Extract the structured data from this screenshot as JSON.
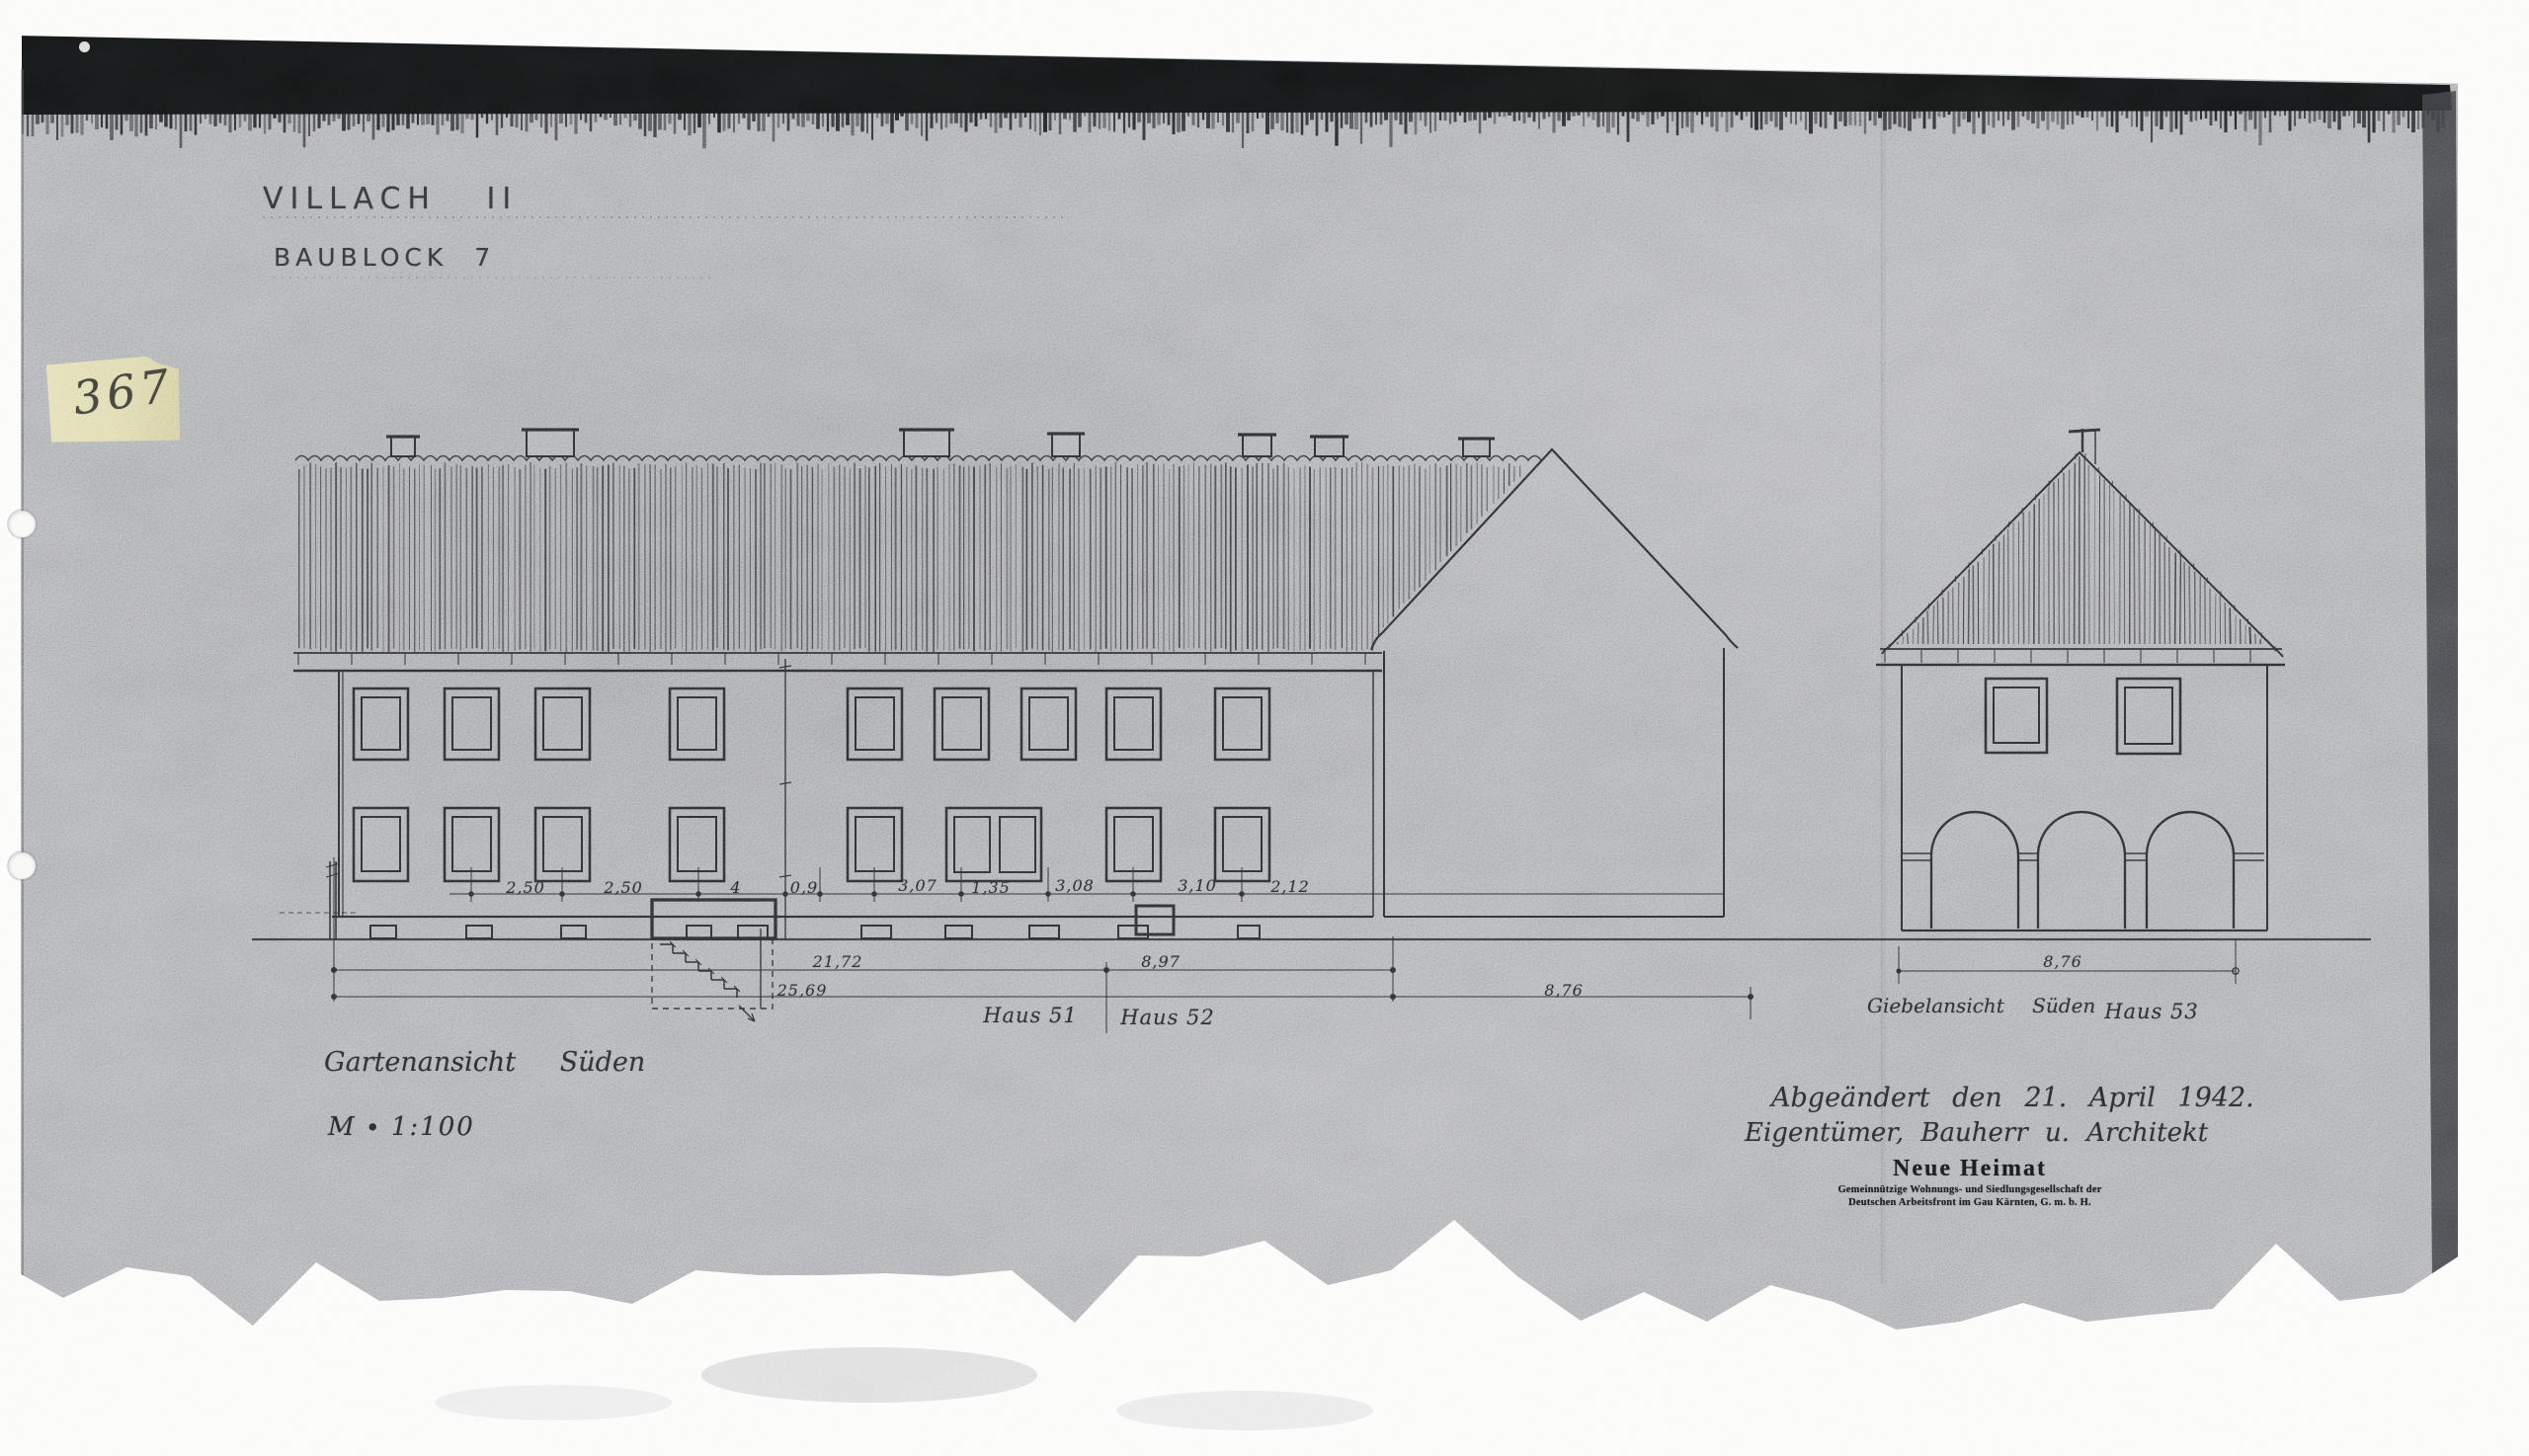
{
  "page": {
    "title": "VILLACH II",
    "subtitle": "BAUBLOCK 7"
  },
  "sticky_note": {
    "number": "367"
  },
  "annotations": {
    "view_left": "Gartenansicht Süden",
    "scale": "M ∙ 1:100",
    "view_right": "Giebelansicht Süden",
    "haus51": "Haus 51",
    "haus52": "Haus 52",
    "haus53": "Haus 53",
    "date_line": "Abgeändert den 21. April 1942.",
    "credit_line": "Eigentümer, Bauherr u. Architekt"
  },
  "stamp": {
    "name": "Neue Heimat",
    "line2": "Gemeinnützige Wohnungs- und Siedlungsgesellschaft der",
    "line3": "Deutschen Arbeitsfront im Gau Kärnten, G. m. b. H."
  },
  "dimensions": {
    "top_row": {
      "d1": "2,50",
      "d2": "2,50",
      "d3": "4",
      "d4": "0,9",
      "d5": "3,07",
      "d6": "1,35",
      "d7": "3,08",
      "d8": "3,10",
      "d9": "2,12"
    },
    "mid_row": {
      "left": "21,72",
      "right": "8,97"
    },
    "bottom_row": {
      "left": "25,69",
      "right": "8,76"
    },
    "haus53_width": "8,76"
  },
  "colors": {
    "paper": "#a2a3a7",
    "ink": "#26272b",
    "note": "#d8d3a0",
    "stamp_ink": "#141518"
  }
}
